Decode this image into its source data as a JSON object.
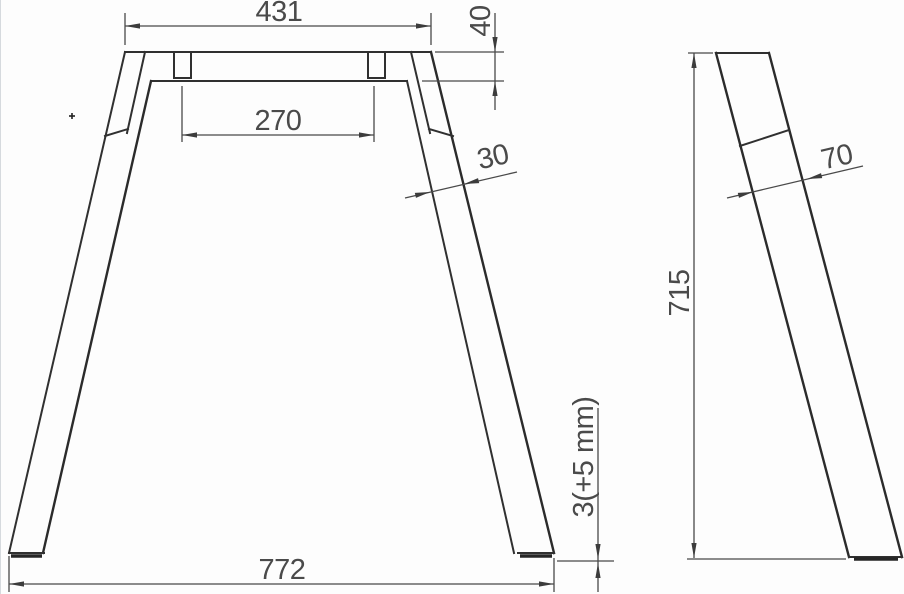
{
  "drawing": {
    "description": "A-frame table leg technical drawing, front view and side view",
    "dimensions": {
      "top_width": "431",
      "apron_height": "40",
      "bracket_spacing": "270",
      "leg_thickness_front": "30",
      "leg_depth_side": "70",
      "overall_height": "715",
      "floor_gap": "3(+5 mm)",
      "base_width": "772"
    },
    "colors": {
      "part_line": "#303030",
      "dimension_line": "#4a4a4a",
      "background": "#fdfdfd"
    }
  }
}
